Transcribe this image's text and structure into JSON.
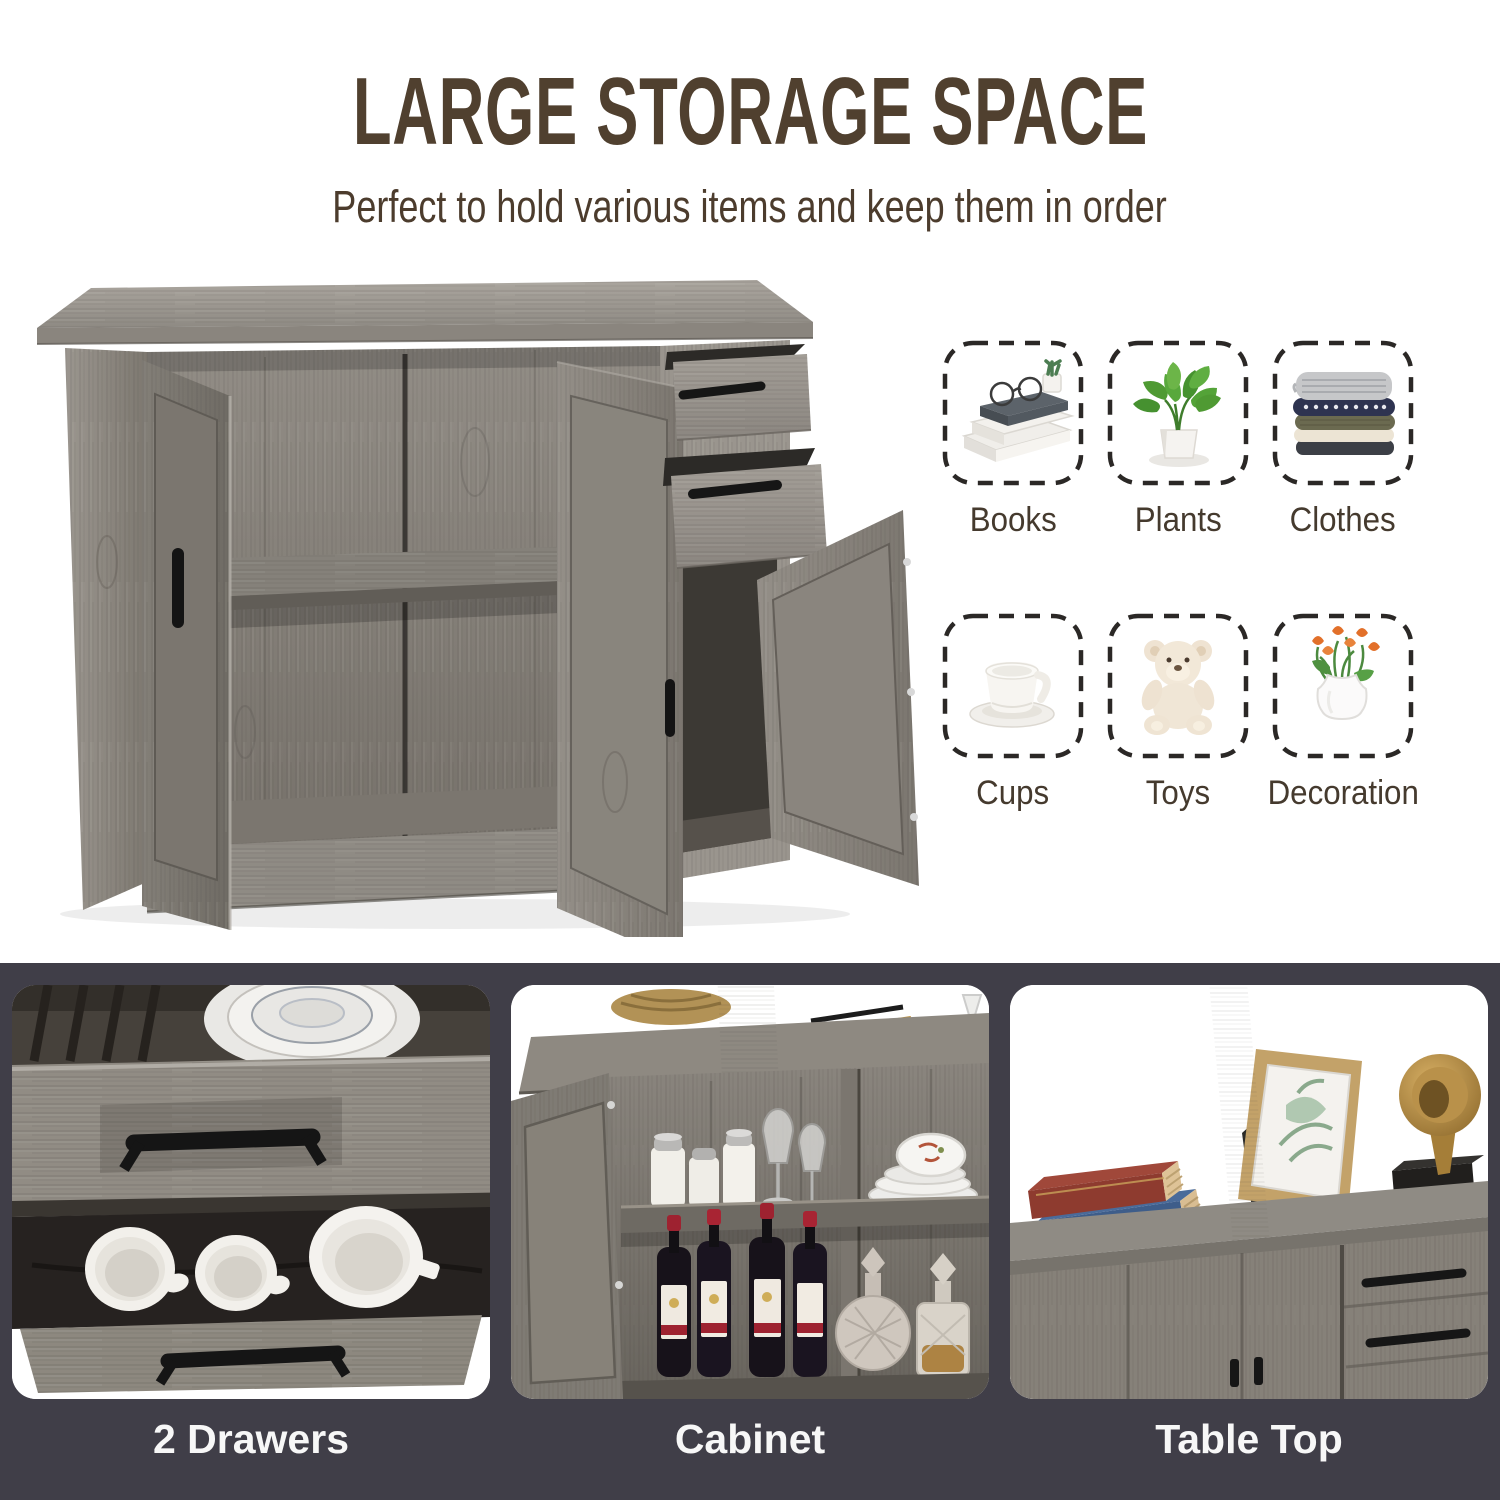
{
  "header": {
    "title": "LARGE STORAGE SPACE",
    "subtitle": "Perfect to hold various items and keep them in order"
  },
  "storage_items": [
    {
      "label": "Books",
      "icon": "books-icon"
    },
    {
      "label": "Plants",
      "icon": "plants-icon"
    },
    {
      "label": "Clothes",
      "icon": "clothes-icon"
    },
    {
      "label": "Cups",
      "icon": "cups-icon"
    },
    {
      "label": "Toys",
      "icon": "toys-icon"
    },
    {
      "label": "Decoration",
      "icon": "decoration-icon"
    }
  ],
  "feature_panels": [
    {
      "caption": "2 Drawers"
    },
    {
      "caption": "Cabinet"
    },
    {
      "caption": "Table Top"
    }
  ],
  "colors": {
    "title_text": "#50402f",
    "subtitle_text": "#4c3c2d",
    "item_label_text": "#453a2e",
    "tile_dash_border": "#2b2826",
    "strip_background": "#403e48",
    "caption_text": "#f7f7f7",
    "wood_light": "#a29d96",
    "wood_mid": "#8b8680",
    "wood_dark": "#5f5b55",
    "handle_black": "#161616",
    "wine_cap_red": "#9e2230",
    "tulip_orange": "#e2702a"
  }
}
